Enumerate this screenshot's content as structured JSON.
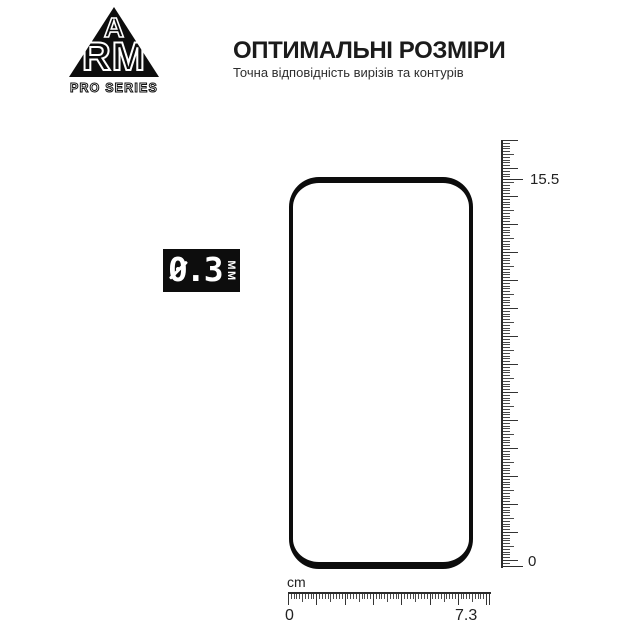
{
  "colors": {
    "ink": "#111111",
    "background": "#ffffff",
    "badge_bg": "#0d0d0d",
    "badge_text": "#ffffff"
  },
  "logo": {
    "top_letter": "A",
    "bottom_letters": "RM",
    "series_label": "PRO SERIES"
  },
  "header": {
    "title": "ОПТИМАЛЬНІ РОЗМІРИ",
    "subtitle": "Точна відповідність вирізів та контурів"
  },
  "thickness_badge": {
    "value": "0.3",
    "unit": "MM"
  },
  "rulers": {
    "vertical": {
      "max_label": "15.5",
      "min_label": "0"
    },
    "horizontal": {
      "unit_label": "cm",
      "min_label": "0",
      "max_label": "7.3"
    }
  }
}
